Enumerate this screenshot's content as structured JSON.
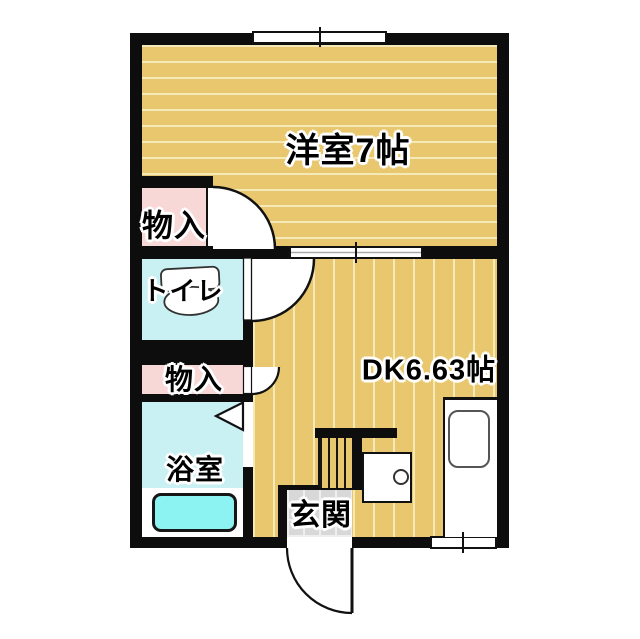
{
  "title": "1DK floor plan",
  "rooms": {
    "western": {
      "label": "洋室7帖"
    },
    "dk": {
      "label": "DK6.63帖"
    },
    "closet_upper": {
      "label": "物入"
    },
    "toilet": {
      "label": "トイレ"
    },
    "closet_lower": {
      "label": "物入"
    },
    "bath": {
      "label": "浴室"
    },
    "entrance": {
      "label": "玄関"
    }
  },
  "colors": {
    "wall": "#0d0d0d",
    "floor_tan": "#e9c76e",
    "floor_stripe": "#f6e9b8",
    "closet_pink": "#f8d7d7",
    "wet_cyan": "#c9f1f4",
    "tub_cyan": "#8df2f2",
    "tile_gray": "#d8d8d8"
  }
}
